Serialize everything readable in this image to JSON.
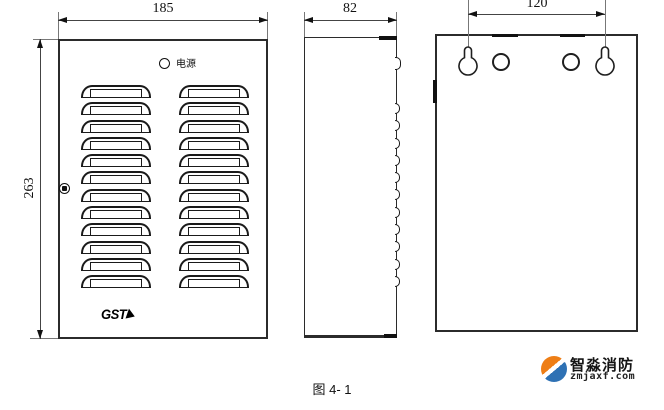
{
  "drawing": {
    "caption": "图 4- 1",
    "front_view": {
      "width_dim": "185",
      "height_dim": "263",
      "power_label": "电源",
      "brand": "GST",
      "louver_rows": 12,
      "louver_columns": 2
    },
    "side_view": {
      "depth_dim": "82",
      "louver_bumps": 11
    },
    "back_view": {
      "hole_spacing_dim": "120",
      "mounting_keyholes": 2,
      "round_holes": 2
    }
  },
  "watermark": {
    "brand": "智淼消防",
    "site": "zmjaxf.com",
    "colors": {
      "orange": "#ee7e16",
      "blue": "#2e71b4"
    }
  },
  "line_colors": {
    "outline": "#2b2b2b",
    "dimension": "#444444"
  }
}
